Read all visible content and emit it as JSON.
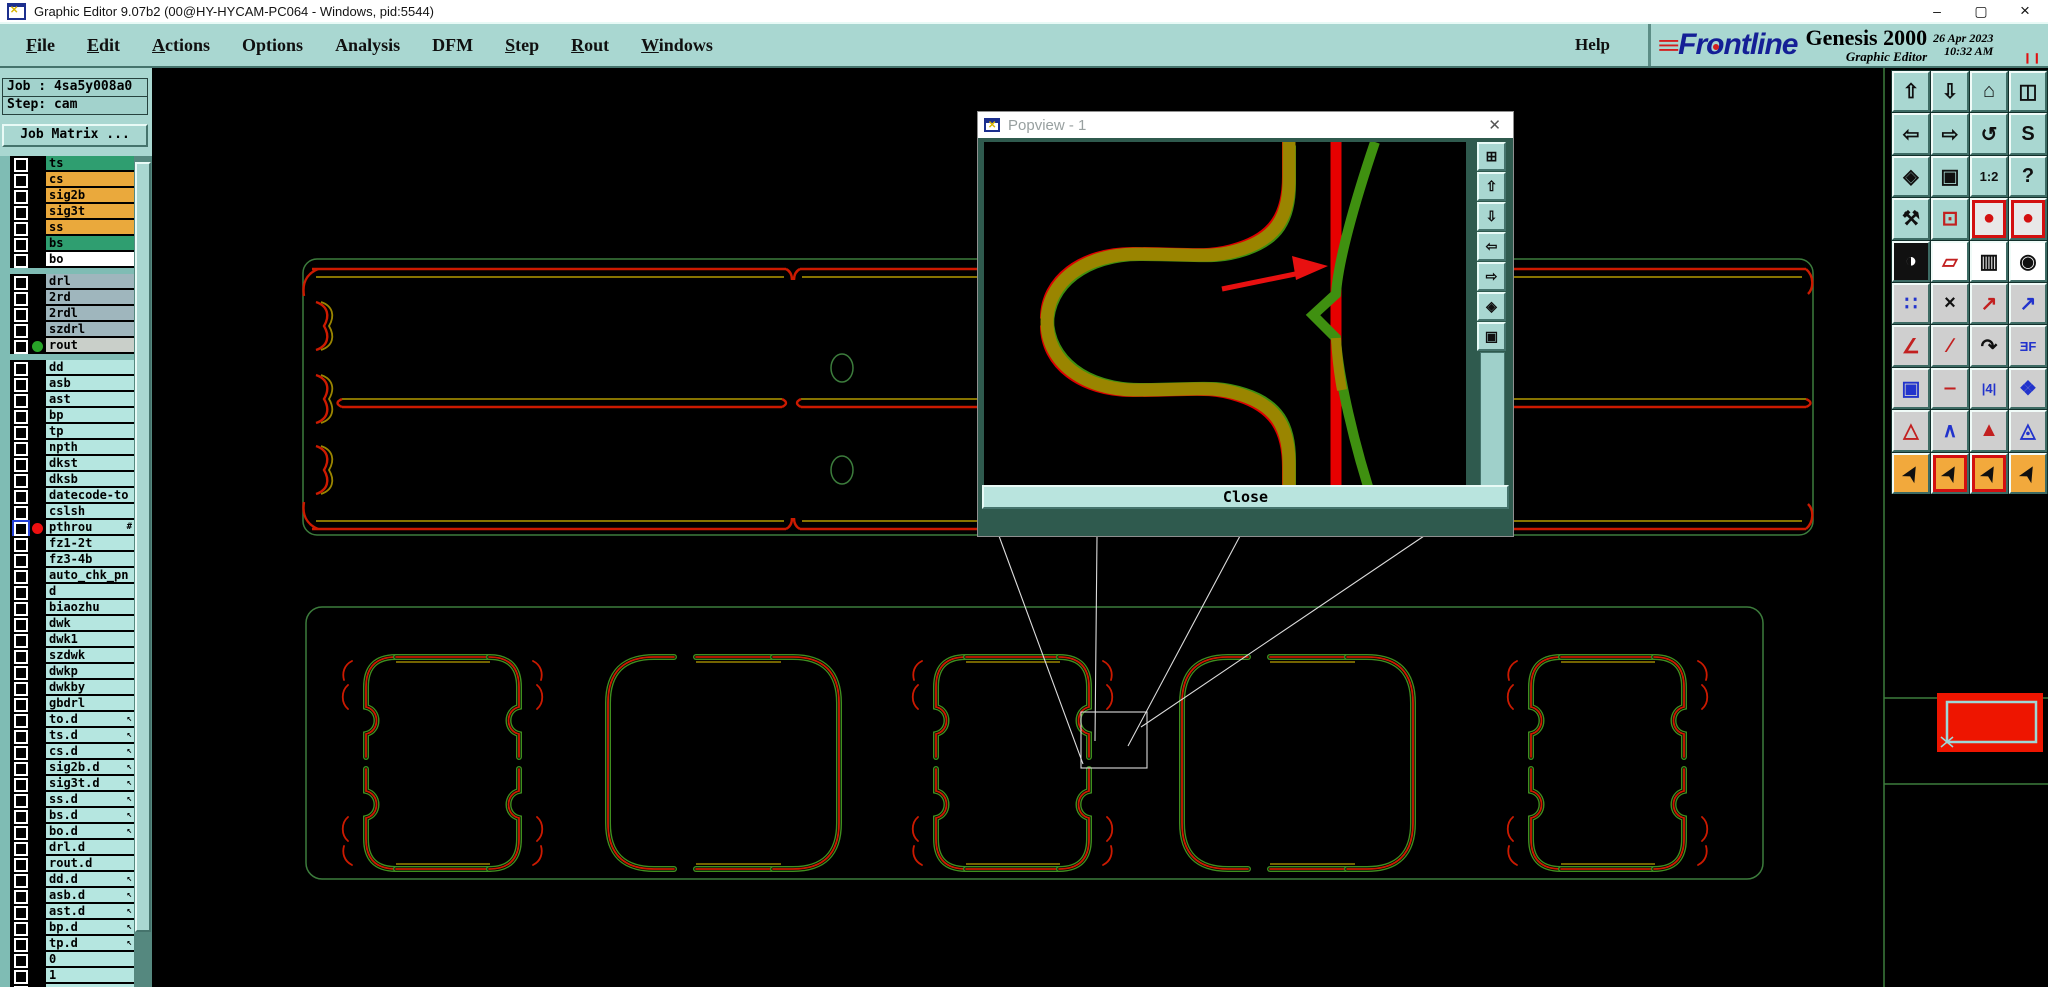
{
  "window": {
    "title": "Graphic Editor 9.07b2 (00@HY-HYCAM-PC064 - Windows, pid:5544)",
    "minimize": "–",
    "maximize": "▢",
    "close": "×"
  },
  "menubar": {
    "items": [
      {
        "label": "File",
        "u": true
      },
      {
        "label": "Edit",
        "u": true
      },
      {
        "label": "Actions",
        "u": true
      },
      {
        "label": "Options",
        "u": false
      },
      {
        "label": "Analysis",
        "u": false
      },
      {
        "label": "DFM",
        "u": false
      },
      {
        "label": "Step",
        "u": true
      },
      {
        "label": "Rout",
        "u": true
      },
      {
        "label": "Windows",
        "u": true
      }
    ],
    "help": "Help"
  },
  "brand": {
    "speed": "≡",
    "logo": {
      "pre": "Fr",
      "o": "o",
      "post": "ntline"
    },
    "product": "Genesis 2000",
    "edition": "Graphic Editor",
    "date": "26 Apr 2023",
    "time": "10:32 AM",
    "pause": "❙❙"
  },
  "sidebar": {
    "job": "Job : 4sa5y008a0",
    "step": "Step: cam",
    "matrix": "Job Matrix ...",
    "groups": [
      [
        {
          "name": "ts",
          "bg": "#2f9e70"
        },
        {
          "name": "cs",
          "bg": "#eaa93c"
        },
        {
          "name": "sig2b",
          "bg": "#eaa93c"
        },
        {
          "name": "sig3t",
          "bg": "#eaa93c"
        },
        {
          "name": "ss",
          "bg": "#eaa93c"
        },
        {
          "name": "bs",
          "bg": "#2f9e70"
        },
        {
          "name": "bo",
          "bg": "#ffffff"
        }
      ],
      [
        {
          "name": "drl",
          "bg": "#9fb6bd"
        },
        {
          "name": "2rd",
          "bg": "#9fb6bd"
        },
        {
          "name": "2rdl",
          "bg": "#9fb6bd"
        },
        {
          "name": "szdrl",
          "bg": "#9fb6bd"
        },
        {
          "name": "rout",
          "bg": "#c9cfc9",
          "dot": "#28a428"
        }
      ],
      [
        {
          "name": "dd",
          "bg": "#b5e6e0"
        },
        {
          "name": "asb",
          "bg": "#b5e6e0"
        },
        {
          "name": "ast",
          "bg": "#b5e6e0"
        },
        {
          "name": "bp",
          "bg": "#b5e6e0"
        },
        {
          "name": "tp",
          "bg": "#b5e6e0"
        },
        {
          "name": "npth",
          "bg": "#b5e6e0"
        },
        {
          "name": "dkst",
          "bg": "#b5e6e0"
        },
        {
          "name": "dksb",
          "bg": "#b5e6e0"
        },
        {
          "name": "datecode-to",
          "bg": "#b5e6e0"
        },
        {
          "name": "cslsh",
          "bg": "#b5e6e0"
        },
        {
          "name": "pthrou",
          "bg": "#b5e6e0",
          "dot": "#ee1010",
          "cb": "#2440d8",
          "suffix": "#"
        },
        {
          "name": "fz1-2t",
          "bg": "#b5e6e0"
        },
        {
          "name": "fz3-4b",
          "bg": "#b5e6e0"
        },
        {
          "name": "auto_chk_pn",
          "bg": "#b5e6e0"
        },
        {
          "name": "d",
          "bg": "#b5e6e0"
        },
        {
          "name": "biaozhu",
          "bg": "#b5e6e0"
        },
        {
          "name": "dwk",
          "bg": "#b5e6e0"
        },
        {
          "name": "dwk1",
          "bg": "#b5e6e0"
        },
        {
          "name": "szdwk",
          "bg": "#b5e6e0"
        },
        {
          "name": "dwkp",
          "bg": "#b5e6e0"
        },
        {
          "name": "dwkby",
          "bg": "#b5e6e0"
        },
        {
          "name": "gbdrl",
          "bg": "#b5e6e0"
        },
        {
          "name": "to.d",
          "bg": "#b5e6e0",
          "suffix": "↖"
        },
        {
          "name": "ts.d",
          "bg": "#b5e6e0",
          "suffix": "↖"
        },
        {
          "name": "cs.d",
          "bg": "#b5e6e0",
          "suffix": "↖"
        },
        {
          "name": "sig2b.d",
          "bg": "#b5e6e0",
          "suffix": "↖"
        },
        {
          "name": "sig3t.d",
          "bg": "#b5e6e0",
          "suffix": "↖"
        },
        {
          "name": "ss.d",
          "bg": "#b5e6e0",
          "suffix": "↖"
        },
        {
          "name": "bs.d",
          "bg": "#b5e6e0",
          "suffix": "↖"
        },
        {
          "name": "bo.d",
          "bg": "#b5e6e0",
          "suffix": "↖"
        },
        {
          "name": "drl.d",
          "bg": "#b5e6e0"
        },
        {
          "name": "rout.d",
          "bg": "#b5e6e0"
        },
        {
          "name": "dd.d",
          "bg": "#b5e6e0",
          "suffix": "↖"
        },
        {
          "name": "asb.d",
          "bg": "#b5e6e0",
          "suffix": "↖"
        },
        {
          "name": "ast.d",
          "bg": "#b5e6e0",
          "suffix": "↖"
        },
        {
          "name": "bp.d",
          "bg": "#b5e6e0",
          "suffix": "↖"
        },
        {
          "name": "tp.d",
          "bg": "#b5e6e0",
          "suffix": "↖"
        },
        {
          "name": "0",
          "bg": "#b5e6e0"
        },
        {
          "name": "1",
          "bg": "#b5e6e0"
        },
        {
          "name": "",
          "bg": "#b5e6e0"
        }
      ]
    ]
  },
  "popview": {
    "title": "Popview - 1",
    "x": "✕",
    "close": "Close",
    "buttons": [
      {
        "n": "pv-popout",
        "g": "⊞"
      },
      {
        "n": "pv-pan-up",
        "g": "⇧"
      },
      {
        "n": "pv-pan-down",
        "g": "⇩"
      },
      {
        "n": "pv-pan-left",
        "g": "⇦"
      },
      {
        "n": "pv-pan-right",
        "g": "⇨"
      },
      {
        "n": "pv-zoom-fit",
        "g": "◈"
      },
      {
        "n": "pv-zoom-extents",
        "g": "▣"
      }
    ]
  },
  "toolbar": {
    "rows": [
      {
        "bg": "#a9d7d1",
        "cells": [
          {
            "n": "pan-up",
            "g": "⇧"
          },
          {
            "n": "pan-down",
            "g": "⇩"
          },
          {
            "n": "home-view",
            "g": "⌂"
          },
          {
            "n": "window-xy",
            "g": "◫"
          }
        ]
      },
      {
        "bg": "#a9d7d1",
        "cells": [
          {
            "n": "pan-left",
            "g": "⇦"
          },
          {
            "n": "pan-right",
            "g": "⇨"
          },
          {
            "n": "zoom-previous",
            "g": "↺"
          },
          {
            "n": "s-route",
            "g": "S"
          }
        ]
      },
      {
        "bg": "#a9d7d1",
        "cells": [
          {
            "n": "zoom-out",
            "g": "◈"
          },
          {
            "n": "zoom-in",
            "g": "▣"
          },
          {
            "n": "zoom-1-2",
            "g": "1:2",
            "small": true
          },
          {
            "n": "help-mark",
            "g": "?"
          }
        ]
      },
      {
        "bg": "#a9d7d1",
        "cells": [
          {
            "n": "setup-tools",
            "g": "⚒"
          },
          {
            "n": "origin-target",
            "g": "⊡",
            "fg": "#c22020"
          },
          {
            "n": "display-mode-1",
            "g": "●",
            "fg": "#d31010",
            "bg": "#e8e8e8",
            "frame": 1
          },
          {
            "n": "display-mode-2",
            "g": "●",
            "fg": "#d31010",
            "bg": "#e8e8e8",
            "frame": 1
          }
        ]
      },
      {
        "bg": "#cfcfcf",
        "cells": [
          {
            "n": "copy-invert",
            "g": "◑",
            "fg": "#ffffff",
            "bg": "#111111"
          },
          {
            "n": "transform-shape",
            "g": "▱",
            "fg": "#c22020",
            "bg": "#ffffff"
          },
          {
            "n": "measure-ruler",
            "g": "▥",
            "bg": "#ffffff"
          },
          {
            "n": "pad-dot",
            "g": "◉",
            "bg": "#ffffff"
          }
        ]
      },
      {
        "bg": "#cfcfcf",
        "cells": [
          {
            "n": "net-points",
            "g": "∷",
            "fg": "#2233cc"
          },
          {
            "n": "delete-x",
            "g": "×"
          },
          {
            "n": "move-feature",
            "g": "↗",
            "fg": "#c22020"
          },
          {
            "n": "copy-feature",
            "g": "↗",
            "fg": "#2233cc"
          }
        ]
      },
      {
        "bg": "#cfcfcf",
        "cells": [
          {
            "n": "angle-tool",
            "g": "∠",
            "fg": "#c22020"
          },
          {
            "n": "slant-line",
            "g": "∕",
            "fg": "#c22020"
          },
          {
            "n": "arc-tool",
            "g": "↷"
          },
          {
            "n": "mirror-tool",
            "g": "ƎF",
            "fg": "#2233cc",
            "small": true
          }
        ]
      },
      {
        "bg": "#cfcfcf",
        "cells": [
          {
            "n": "copy-to-layer",
            "g": "▣",
            "fg": "#2233cc"
          },
          {
            "n": "break-tool",
            "g": "‒",
            "fg": "#c22020"
          },
          {
            "n": "spacing-4",
            "g": "|4|",
            "fg": "#2233cc",
            "small": true
          },
          {
            "n": "surface-tool",
            "g": "❖",
            "fg": "#2233cc"
          }
        ]
      },
      {
        "bg": "#cfcfcf",
        "cells": [
          {
            "n": "tri-mode-1",
            "g": "△",
            "fg": "#c22020"
          },
          {
            "n": "tri-mode-2",
            "g": "∧",
            "fg": "#2233cc"
          },
          {
            "n": "tri-mode-3",
            "g": "▲",
            "fg": "#c22020"
          },
          {
            "n": "tri-mode-4",
            "g": "◬",
            "fg": "#2233cc"
          }
        ]
      },
      {
        "bg": "#f2a93c",
        "cells": [
          {
            "n": "select-single",
            "g": "➤",
            "rot": 1
          },
          {
            "n": "select-frame",
            "g": "➤",
            "rot": 1,
            "frame": 1
          },
          {
            "n": "select-poly",
            "g": "➤",
            "rot": 1,
            "frame": 1
          },
          {
            "n": "select-net",
            "g": "➤",
            "rot": 1
          }
        ]
      }
    ]
  },
  "colors": {
    "ui_teal": "#a9d7d1",
    "canvas_black": "#000000",
    "rout_olive": "#9a8500",
    "rout_red": "#e60000",
    "rout_green": "#3f9010",
    "panel_green": "#3c7c3c",
    "selection_red": "#ee1500",
    "selection_cyan": "#9fd8d8"
  }
}
